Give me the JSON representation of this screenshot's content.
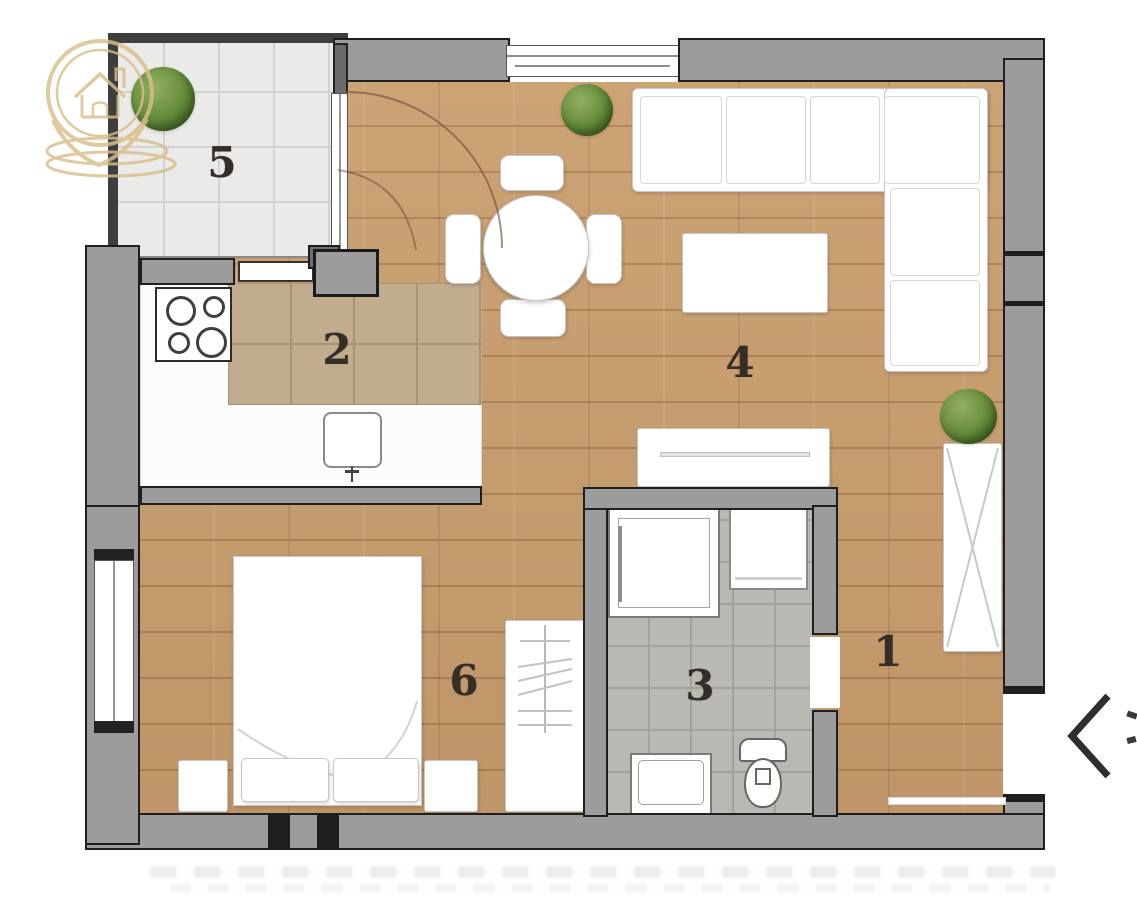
{
  "page": {
    "background": "#ffffff"
  },
  "floorplan": {
    "type": "apartment-floor-plan",
    "rooms": [
      {
        "label": "1",
        "name": "hallway"
      },
      {
        "label": "2",
        "name": "kitchen"
      },
      {
        "label": "3",
        "name": "bathroom"
      },
      {
        "label": "4",
        "name": "living-dining-room"
      },
      {
        "label": "5",
        "name": "balcony"
      },
      {
        "label": "6",
        "name": "bedroom"
      }
    ],
    "colors": {
      "wood_floor": "#c99e6e",
      "kitchen_tile": "#c2ac8e",
      "kitchen_tile_line": "#a8937a",
      "bath_tile": "#bab8b3",
      "bath_tile_line": "#a3a19c",
      "balcony_tile": "#eaeae8",
      "balcony_tile_line": "#d2d2cf",
      "wall": "#9c9c9c",
      "wall_outline": "#1f1f1f",
      "furniture": "#ffffff",
      "furniture_line": "#c6c6c6",
      "plant_green": "#628b38",
      "logo_gold": "#d8bf8c",
      "room_number": "#342e26",
      "chevron": "#2e2e2e"
    }
  },
  "watermark": {
    "icon": "house-location-pin-logo"
  },
  "carousel": {
    "prev_button": "chevron-left"
  }
}
